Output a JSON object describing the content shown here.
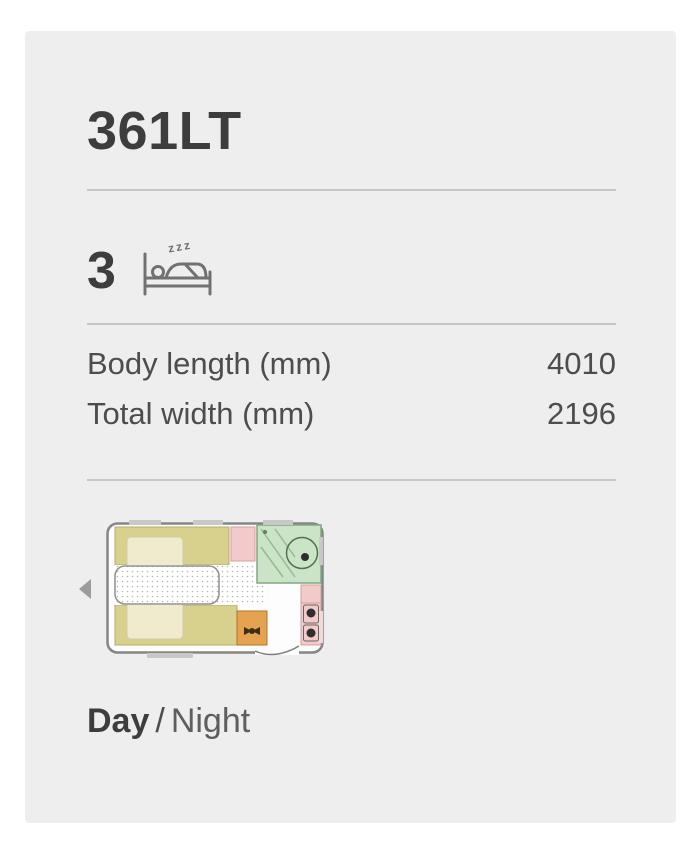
{
  "card": {
    "title": "361LT",
    "berths": {
      "count": "3",
      "zzz": "zzz",
      "icon": "bed-sleeper-icon"
    },
    "specs": [
      {
        "label": "Body length (mm)",
        "value": "4010"
      },
      {
        "label": "Total width (mm)",
        "value": "2196"
      }
    ],
    "floorplan": {
      "nav_icon": "prev-arrow-icon",
      "colors": {
        "body_outline": "#858585",
        "seating": "#d8d08d",
        "table": "#f0ebcd",
        "washroom_green": "#cbe3c7",
        "furniture_pink": "#f2caca",
        "cabinet_orange": "#e5a24f"
      }
    },
    "view_toggle": {
      "day": "Day",
      "separator": "/",
      "night": "Night"
    }
  },
  "colors": {
    "card_background": "#eeeeee",
    "divider": "#c6c6c6",
    "text_dark": "#3d3d3d",
    "text_medium": "#4d4d4d"
  }
}
